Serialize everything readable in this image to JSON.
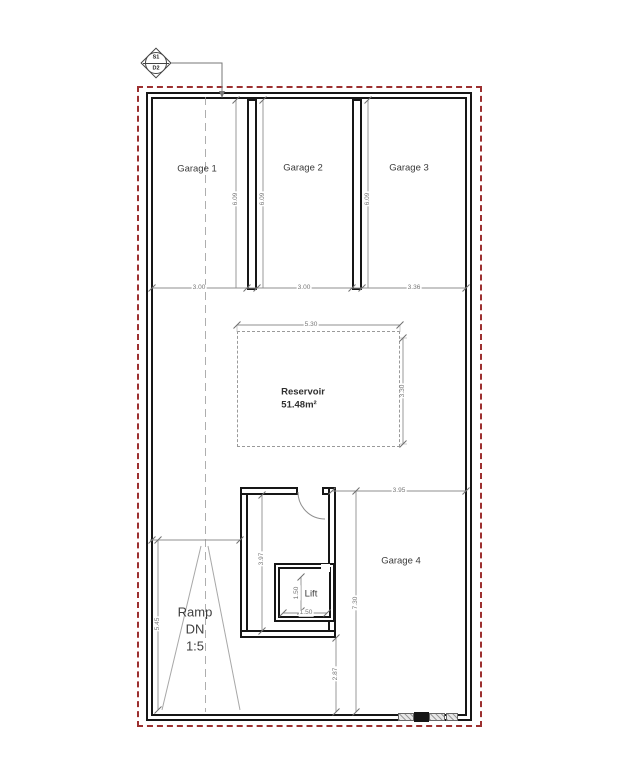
{
  "drawing": {
    "section_marker": {
      "top": "S1",
      "bottom": "D2"
    },
    "rooms": {
      "garage1": "Garage 1",
      "garage2": "Garage 2",
      "garage3": "Garage 3",
      "garage4": "Garage 4",
      "reservoir_name": "Reservoir",
      "reservoir_area": "51.48m²",
      "lift": "Lift",
      "ramp_line1": "Ramp",
      "ramp_line2": "DN",
      "ramp_line3": "1:5"
    },
    "dims": {
      "garage1_width": "3.00",
      "garage2_width": "3.00",
      "garage3_width": "3.36",
      "garage1_depth": "6.09",
      "garage2_depth": "6.09",
      "garage3_depth": "6.09",
      "reservoir_width": "5.30",
      "reservoir_depth": "3.30",
      "garage4_width": "3.95",
      "garage4_depth": "7.30",
      "stair_depth": "3.97",
      "lift_width": "1.50",
      "lift_depth": "1.50",
      "lift_to_wall": "2.87",
      "ramp_length": "5.45"
    },
    "colors": {
      "wall": "#161616",
      "boundary": "#9c3030",
      "dimension": "#8f8f8f",
      "label": "#3a3a3a"
    }
  }
}
